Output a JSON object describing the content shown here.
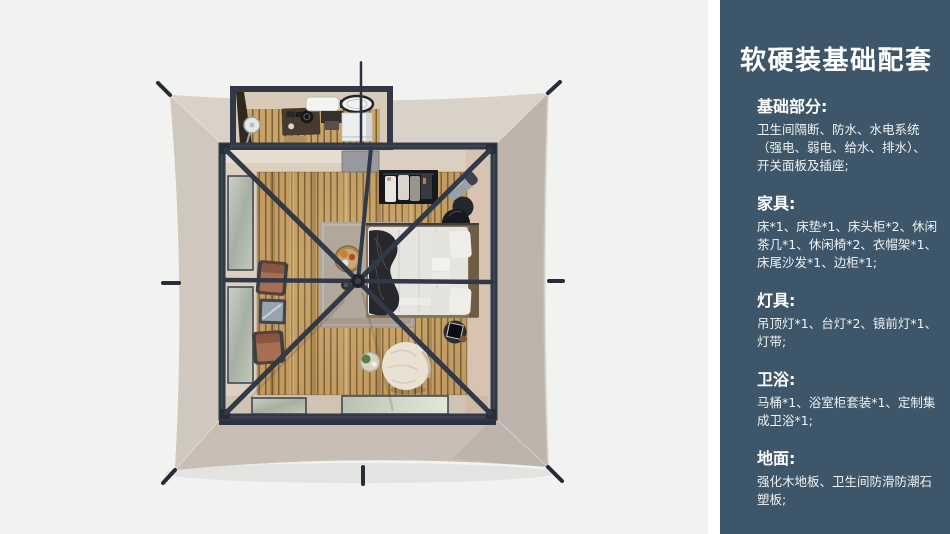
{
  "panel": {
    "title": "软硬装基础配套",
    "sections": [
      {
        "heading": "基础部分:",
        "lines": [
          "卫生间隔断、防水、水电系统",
          "（强电、弱电、给水、排水）、",
          "开关面板及插座;"
        ]
      },
      {
        "heading": "家具:",
        "lines": [
          "床*1、床垫*1、床头柜*2、休闲",
          "茶几*1、休闲椅*2、衣帽架*1、",
          "床尾沙发*1、边柜*1;"
        ]
      },
      {
        "heading": "灯具:",
        "lines": [
          "吊顶灯*1、台灯*2、镜前灯*1、",
          "灯带;"
        ]
      },
      {
        "heading": "卫浴:",
        "lines": [
          "马桶*1、浴室柜套装*1、定制集",
          "成卫浴*1;"
        ]
      },
      {
        "heading": "地面:",
        "lines": [
          "强化木地板、卫生间防滑防潮石",
          "塑板;"
        ]
      }
    ]
  },
  "scene": {
    "kind": "top-view-3d-render",
    "subject": "square glamping tent with interior furnishing",
    "items": [
      "tent-canvas",
      "guy-line-stakes",
      "bathroom-annex",
      "standing-fan",
      "coffee-station-desk",
      "skylight",
      "washbasin",
      "washing-machine",
      "room-frame",
      "roof-beams",
      "center-hub",
      "wood-slat-deck",
      "mesh-windows",
      "doorway-mat",
      "coat-rack-with-clothes",
      "leaning-luggage-stand",
      "black-round-stools",
      "double-bed",
      "pillows",
      "dark-throw-blanket",
      "area-rug",
      "round-breakfast-table",
      "lounge-chair",
      "tea-table",
      "bean-bag-pouf",
      "small-plant-table",
      "speaker-side-table"
    ]
  },
  "theme": {
    "panel_bg": "#3e5669",
    "panel_text": "#eef2f4",
    "scene_bg": "#f2f2f1",
    "canvas": "#cdc4bb",
    "canvas_top": "#d9d2c9",
    "canvas_left": "#d0c8bf",
    "canvas_right": "#bdb4ab",
    "canvas_bottom": "#c8beb5",
    "frame": "#313948",
    "stake": "#252c3a",
    "wood": "#c29a5e",
    "wood_light": "#d2ae72",
    "wood_gap": "#7d6038",
    "floor_border": "#dccfbf",
    "rug": "#b2a79b",
    "bed": "#e6e4e0",
    "throw": "#26282d",
    "chair": "#a86e52",
    "pouf": "#e9e2d3"
  }
}
